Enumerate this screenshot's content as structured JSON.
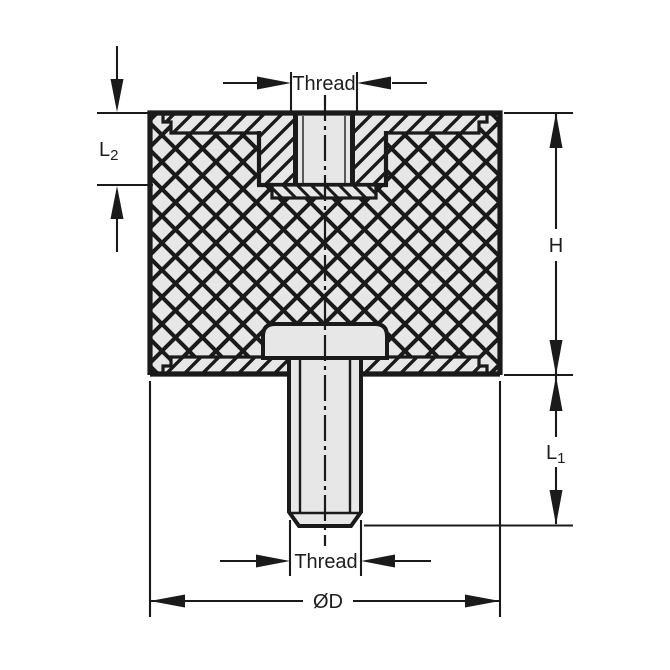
{
  "figure": {
    "subject": "cross-section drawing of cylindrical rubber-metal mount with female thread on top and male stud below",
    "colors": {
      "background": "#ffffff",
      "line": "#1a1a1a",
      "metal_fill": "#e7e7e7",
      "text": "#1d1d1d"
    },
    "dimensions": {
      "thread_top": {
        "label": "Thread"
      },
      "l2": {
        "label": "L",
        "subscript": "2"
      },
      "h": {
        "label": "H"
      },
      "l1": {
        "label": "L",
        "subscript": "1"
      },
      "thread_bottom": {
        "label": "Thread"
      },
      "diameter": {
        "label": "ØD"
      }
    }
  }
}
